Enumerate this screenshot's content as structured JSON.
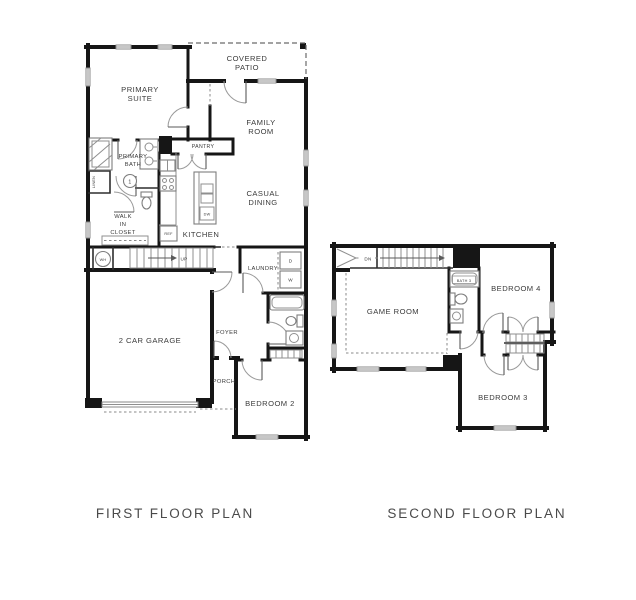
{
  "colors": {
    "background": "#ffffff",
    "wall": "#161616",
    "label_text": "#3b3b3b",
    "caption_text": "#4a4a4a",
    "detail_line": "#8f8f8f"
  },
  "captions": {
    "first_floor": "FIRST FLOOR PLAN",
    "second_floor": "SECOND FLOOR PLAN"
  },
  "first_floor": {
    "rooms": {
      "covered_patio": [
        "COVERED",
        "PATIO"
      ],
      "primary_suite": [
        "PRIMARY",
        "SUITE"
      ],
      "family_room": [
        "FAMILY",
        "ROOM"
      ],
      "casual_dining": [
        "CASUAL",
        "DINING"
      ],
      "kitchen": "KITCHEN",
      "pantry": "PANTRY",
      "primary_bath": [
        "PRIMARY",
        "BATH"
      ],
      "walk_in_closet": [
        "WALK",
        "IN",
        "CLOSET"
      ],
      "linen": "LINEN",
      "laundry": "LAUNDRY",
      "foyer": "FOYER",
      "porch": "PORCH",
      "garage": "2 CAR GARAGE",
      "bedroom_2": "BEDROOM 2"
    },
    "annotations": {
      "up": "UP",
      "water_heater": "WH",
      "refrigerator": "REF",
      "dishwasher": "DW",
      "dryer": "D",
      "washer": "W",
      "keynote": "1"
    }
  },
  "second_floor": {
    "rooms": {
      "game_room": "GAME ROOM",
      "bath_3": "BATH 3",
      "bedroom_4": "BEDROOM 4",
      "bedroom_3": "BEDROOM 3"
    },
    "annotations": {
      "dn": "DN"
    }
  }
}
